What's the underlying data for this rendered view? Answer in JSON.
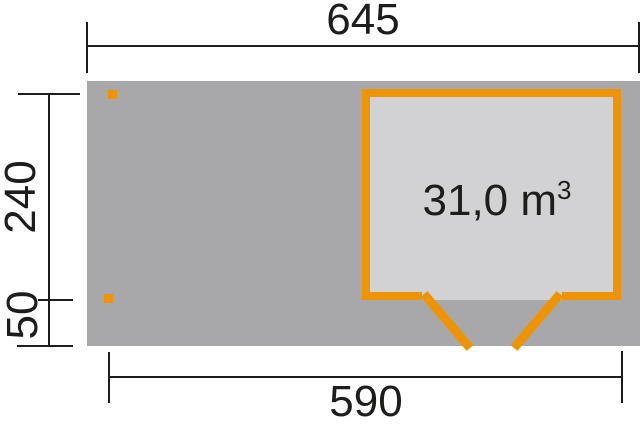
{
  "diagram": {
    "type": "floor-plan",
    "dimensions": {
      "top_width": "645",
      "left_height": "240",
      "left_depth": "50",
      "bottom_width": "590"
    },
    "volume": {
      "value": "31,0 m",
      "exponent": "3"
    },
    "colors": {
      "base_area": "#a8a8aa",
      "shed_interior": "#d2d2d4",
      "accent_orange": "#ee9400",
      "line": "#1d1d1b",
      "background": "#ffffff"
    }
  }
}
